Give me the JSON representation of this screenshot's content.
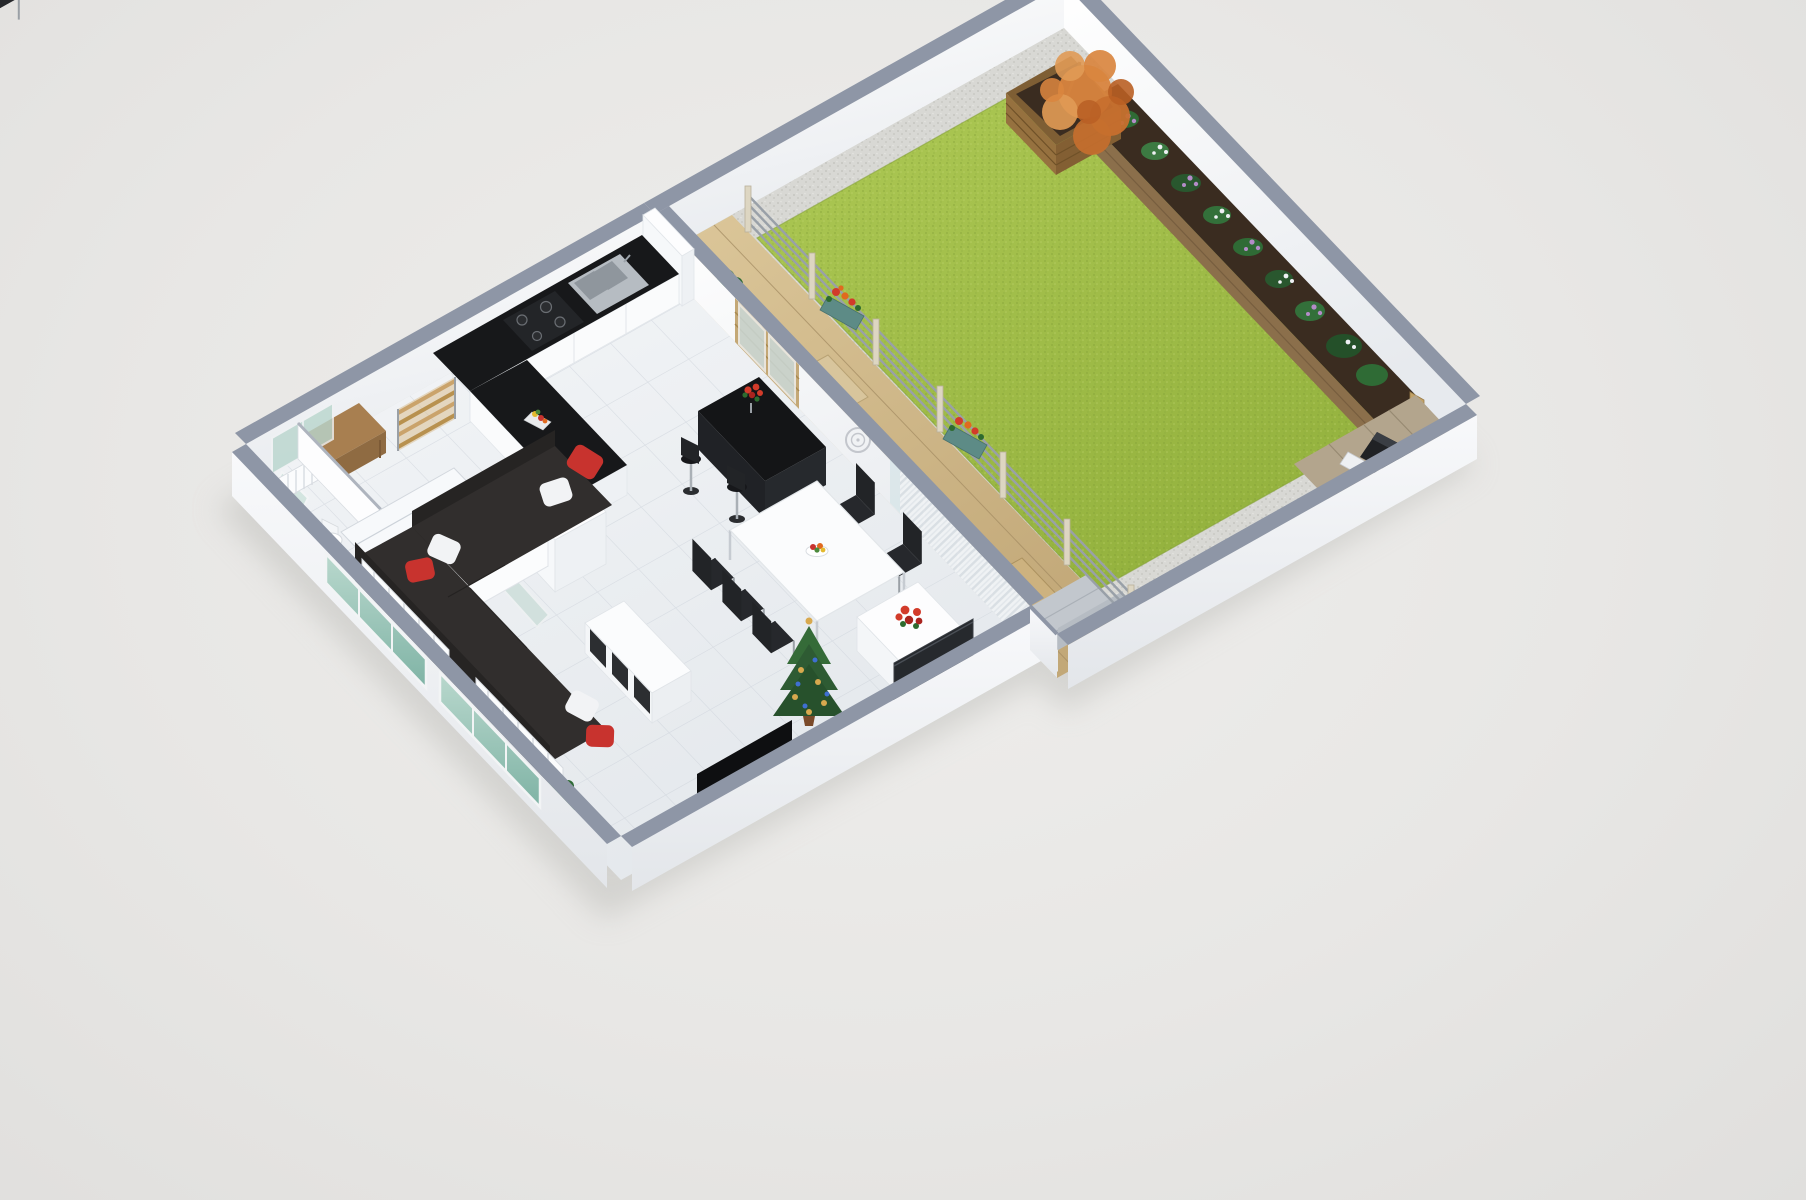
{
  "meta": {
    "kind": "isometric-3d-floor-plan-render",
    "description": "3D cutaway floor plan of an apartment with open living/dining/kitchen, hallway, WC, stairs, wooden terrace and a walled private garden",
    "visible_text": []
  },
  "palette": {
    "background": "#e9e8e6",
    "shadow": "#bdbdb9",
    "wall_cap": "#8e96a6",
    "wall_face_outer": "#f3f5f7",
    "wall_face_inner": "#fcfdfe",
    "floor_tile": "#eef1f4",
    "tile_line": "#ccd2da",
    "lawn": "#a6c14f",
    "lawn_dark": "#8fae3e",
    "gravel": "#d8d8d4",
    "deck_wood": "#d3bd90",
    "deck_line": "#a58d63",
    "gray_deck": "#b3a58d",
    "planter_wood": "#96713f",
    "bed_wood": "#8b6f4b",
    "soil": "#3a2c20",
    "tree_orange": "#d9853f",
    "bush_green": "#2f6b35",
    "counter_black": "#17181a",
    "cabinet_white": "#fafbfc",
    "wood_furniture": "#a87f50",
    "bar_black": "#141517",
    "chair_black": "#222427",
    "sofa_dark": "#312e2d",
    "sofa_back": "#262423",
    "cushion_red": "#c8332e",
    "cushion_white": "#f2f3f5",
    "curtain": "#e9edf0",
    "glass_green": "#9ec7bb",
    "glass_light": "#d8e5e9",
    "railing_metal": "#99a0a8",
    "post_cream": "#ddd6c2",
    "flower_red": "#d23b2a",
    "flower_orange": "#e06a1f",
    "flower_purple": "#b48cc8",
    "flower_white": "#eef0f4",
    "tv_black": "#0e0f11",
    "christmas_green": "#2e5b33",
    "ornament_gold": "#d8a94e",
    "ornament_blue": "#3f6fd1",
    "outdoor_sofa": "#c2c7cd"
  },
  "scene": {
    "areas": [
      {
        "name": "kitchen",
        "objects": [
          "wall-cabinets",
          "base-cabinets",
          "black-l-countertop",
          "cooktop",
          "double-sink",
          "fruit-tray",
          "fridge",
          "tall-corner-unit",
          "glass-interior-door"
        ]
      },
      {
        "name": "hallway",
        "objects": [
          "wooden-ladder-shelf",
          "wooden-console-table",
          "open-white-door",
          "casement-windows",
          "radiator"
        ]
      },
      {
        "name": "wc",
        "objects": [
          "toilet",
          "partition-walls",
          "door-leaf"
        ]
      },
      {
        "name": "staircase",
        "objects": [
          "winder-stairs",
          "white-balustrade"
        ]
      },
      {
        "name": "living-dining",
        "objects": [
          "black-bar-table",
          "bar-stools",
          "red-flower-vase",
          "white-dining-table",
          "black-dining-chairs",
          "fruit-bowl",
          "dark-corner-sofa",
          "red-pillows",
          "white-pillows",
          "cube-coffee-table",
          "tv-screen",
          "media-console",
          "wall-tv-panel",
          "christmas-tree",
          "white-sideboard",
          "poinsettia",
          "floor-plant",
          "sheer-curtains",
          "glass-sliding-wall",
          "patio-door",
          "wall-medallion",
          "window-radiators",
          "green-glass-windows"
        ]
      },
      {
        "name": "terrace",
        "objects": [
          "wooden-deck",
          "doormat",
          "doormat-2",
          "potted-plant",
          "outdoor-gray-sofa",
          "metal-railing",
          "railing-flower-boxes"
        ]
      },
      {
        "name": "garden",
        "objects": [
          "lawn",
          "gravel-border",
          "raised-flower-bed",
          "flower-clusters",
          "bed-end-post",
          "wooden-planter-box",
          "autumn-orange-tree",
          "bbq-grill",
          "grill-deck"
        ]
      }
    ],
    "counts": {
      "bar_stools": 2,
      "dining_chairs": 5,
      "sofa_pillows": 6,
      "fence_posts": 7,
      "railing_flower_boxes": 2
    }
  }
}
